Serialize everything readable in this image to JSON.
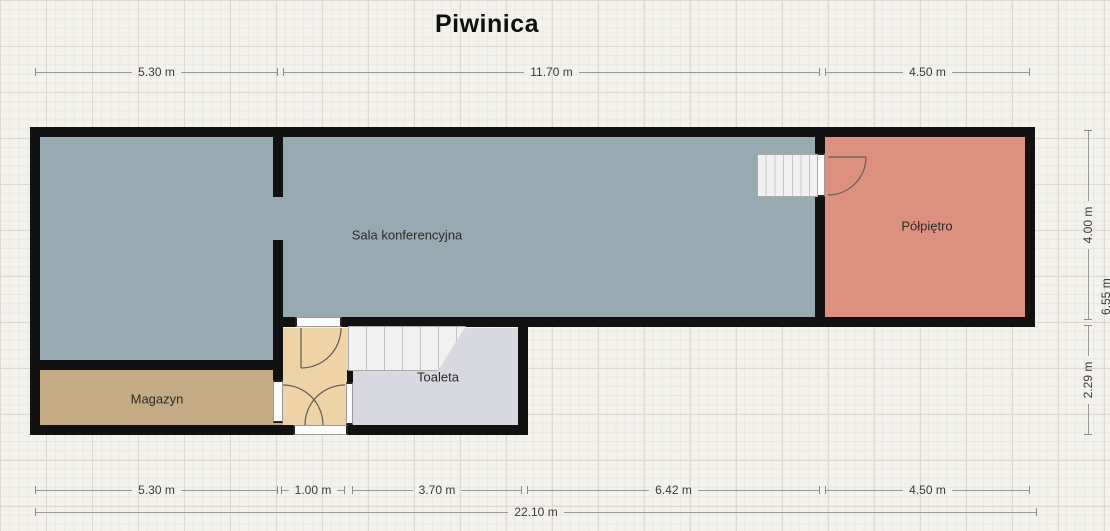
{
  "title": "Piwinica",
  "rooms": {
    "sala": {
      "label": "Sala konferencyjna"
    },
    "polpietro": {
      "label": "Półpiętro"
    },
    "magazyn": {
      "label": "Magazyn"
    },
    "toaleta": {
      "label": "Toaleta"
    }
  },
  "dimensions": {
    "top": [
      "5.30 m",
      "11.70 m",
      "4.50 m"
    ],
    "right": [
      "4.00 m",
      "2.29 m"
    ],
    "bottom": [
      "5.30 m",
      "1.00 m",
      "3.70 m",
      "6.42 m",
      "4.50 m"
    ],
    "total": "22.10 m",
    "clipped_right_edge": "6.55 m"
  },
  "colors": {
    "room_conference": "#97aab2",
    "room_mezzanine": "#de9080",
    "room_storage": "#c4aa85",
    "room_toilet": "#d7d8e0",
    "vestibule": "#edd3a6",
    "wall": "#111111",
    "background": "#f3f2ed"
  }
}
